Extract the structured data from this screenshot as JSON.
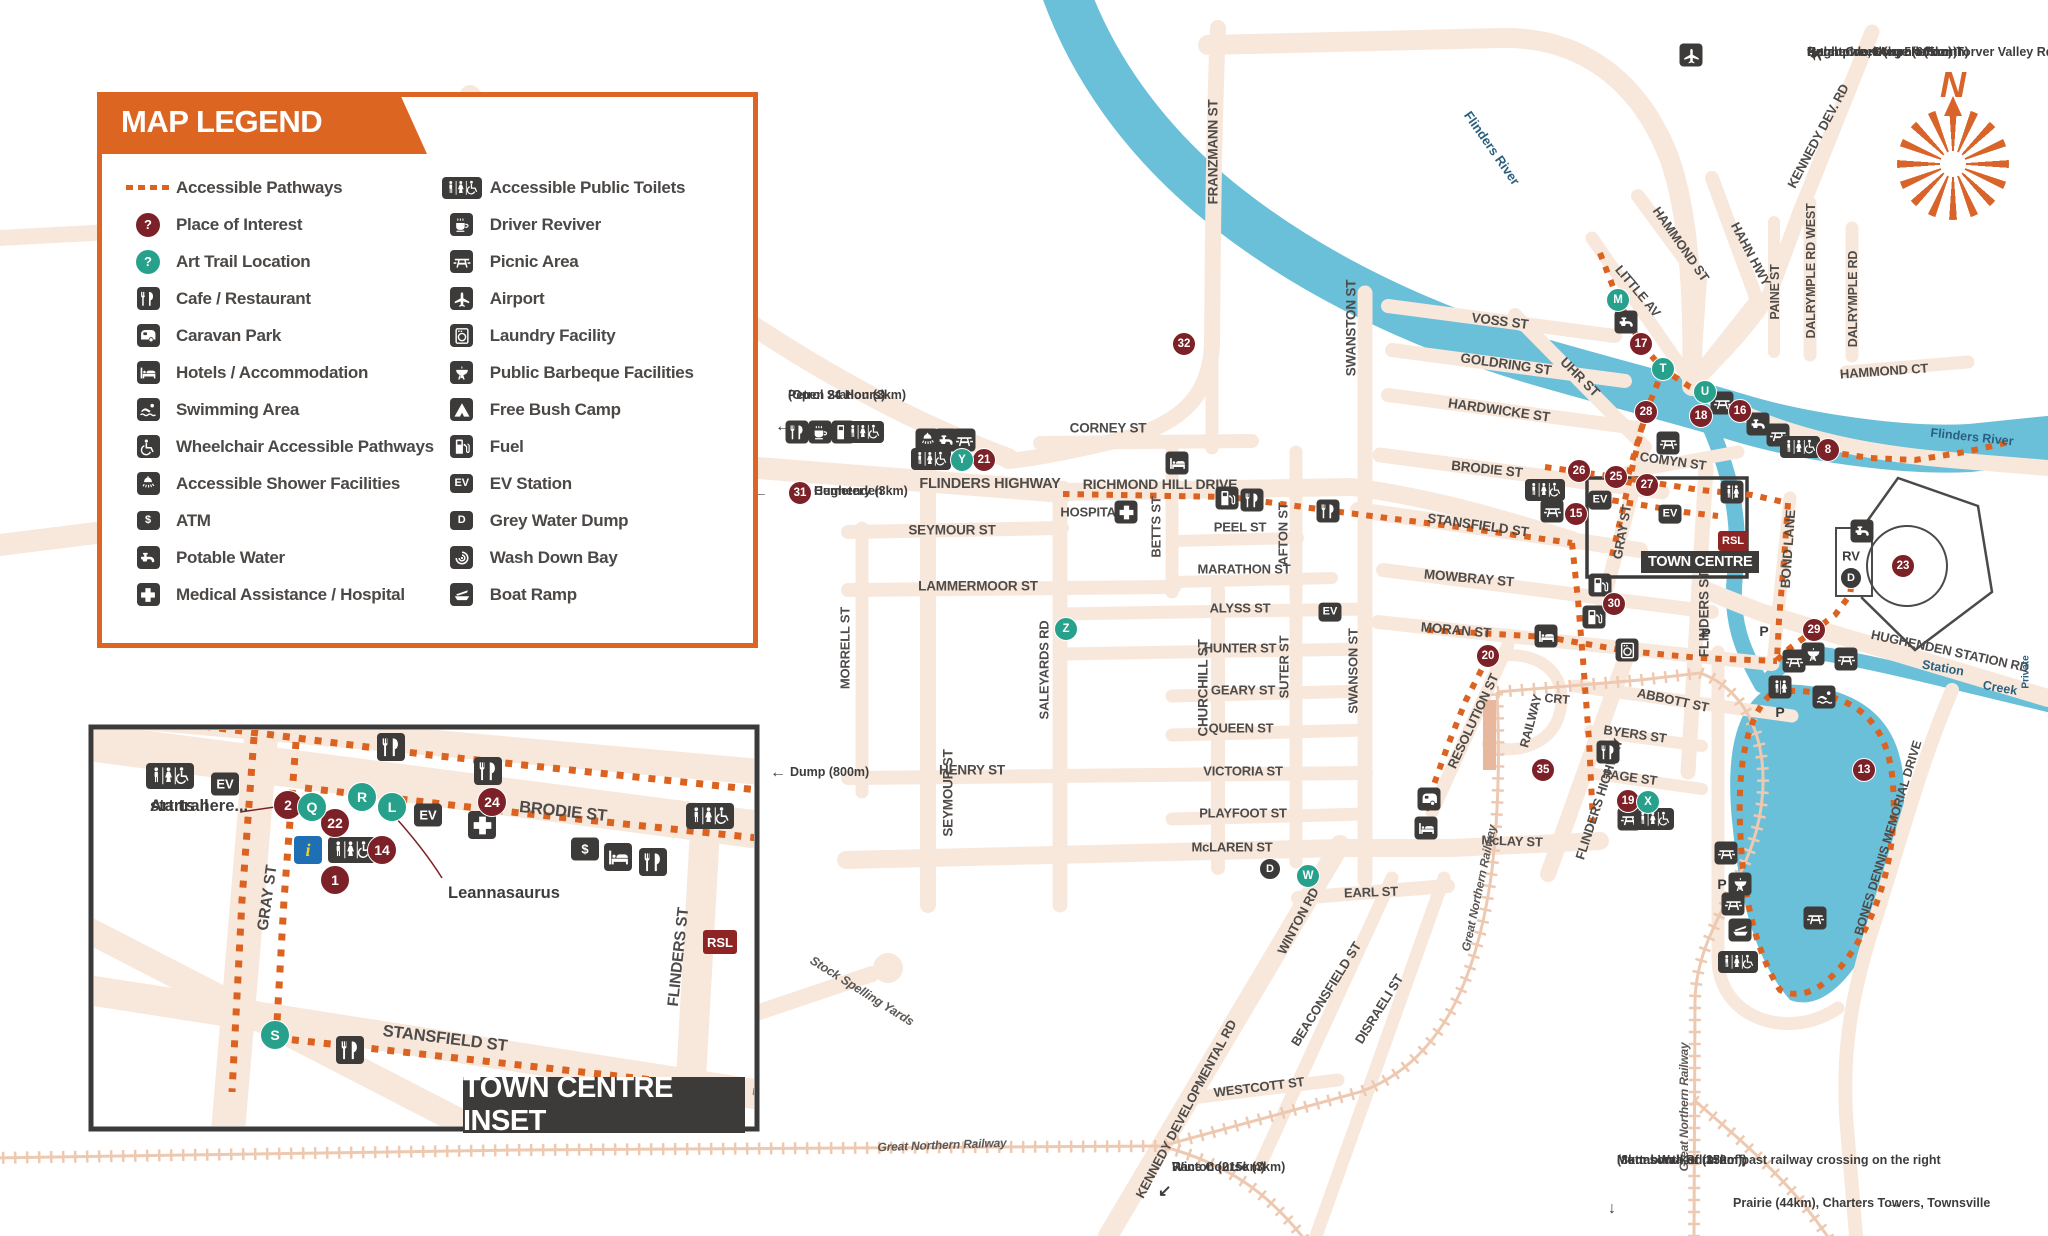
{
  "colors": {
    "road": "#f8e8dc",
    "river": "#6abfd9",
    "orange": "#dc6220",
    "dark": "#3d3b3a",
    "maroon": "#7c2127",
    "teal": "#27a18c",
    "street_text": "#4e4b49",
    "water_text": "#29607f",
    "railway": "#eec9b1"
  },
  "legend": {
    "title": "MAP LEGEND",
    "left": [
      {
        "icon": "dotted",
        "label": "Accessible Pathways"
      },
      {
        "icon": "poi",
        "label": "Place of Interest"
      },
      {
        "icon": "art",
        "label": "Art Trail Location"
      },
      {
        "icon": "cafe",
        "label": "Cafe / Restaurant"
      },
      {
        "icon": "caravan",
        "label": "Caravan Park"
      },
      {
        "icon": "hotel",
        "label": "Hotels / Accommodation"
      },
      {
        "icon": "swim",
        "label": "Swimming Area"
      },
      {
        "icon": "wheelchair",
        "label": "Wheelchair Accessible Pathways"
      },
      {
        "icon": "shower",
        "label": "Accessible Shower Facilities"
      },
      {
        "icon": "atm",
        "label": "ATM"
      },
      {
        "icon": "tap",
        "label": "Potable Water"
      },
      {
        "icon": "cross",
        "label": "Medical Assistance / Hospital"
      }
    ],
    "right": [
      {
        "icon": "wc",
        "label": "Accessible Public Toilets"
      },
      {
        "icon": "coffee",
        "label": "Driver Reviver"
      },
      {
        "icon": "picnic",
        "label": "Picnic Area"
      },
      {
        "icon": "plane",
        "label": "Airport"
      },
      {
        "icon": "laundry",
        "label": "Laundry Facility"
      },
      {
        "icon": "bbq",
        "label": "Public Barbeque Facilities"
      },
      {
        "icon": "tent",
        "label": "Free Bush Camp"
      },
      {
        "icon": "fuel",
        "label": "Fuel"
      },
      {
        "icon": "ev",
        "label": "EV Station"
      },
      {
        "icon": "dumpD",
        "label": "Grey Water Dump"
      },
      {
        "icon": "wash",
        "label": "Wash Down Bay"
      },
      {
        "icon": "boat",
        "label": "Boat Ramp"
      }
    ]
  },
  "inset": {
    "title": "TOWN CENTRE INSET"
  },
  "town_centre_label": "TOWN CENTRE",
  "compass_n": "N",
  "streets": [
    [
      "FRANZMANN ST",
      1213,
      152,
      -90,
      13.5
    ],
    [
      "FLINDERS HIGHWAY",
      990,
      484,
      0,
      14.5
    ],
    [
      "RICHMOND HILL DRIVE",
      1160,
      484,
      0,
      14
    ],
    [
      "CORNEY ST",
      1108,
      428,
      0,
      13.5
    ],
    [
      "SEYMOUR ST",
      952,
      530,
      0,
      13.5
    ],
    [
      "LAMMERMOOR ST",
      978,
      586,
      0,
      13.5
    ],
    [
      "HENRY ST",
      972,
      770,
      0,
      13.5
    ],
    [
      "SEYMOUR ST",
      948,
      793,
      -90,
      13.5
    ],
    [
      "MORRELL ST",
      845,
      648,
      -90,
      13
    ],
    [
      "SALEYARDS RD",
      1044,
      670,
      -90,
      13
    ],
    [
      "CHURCHILL ST",
      1203,
      688,
      -90,
      13.5
    ],
    [
      "BETTS ST",
      1156,
      527,
      -90,
      13
    ],
    [
      "PEEL ST",
      1240,
      527,
      0,
      13
    ],
    [
      "MARATHON ST",
      1244,
      569,
      0,
      13
    ],
    [
      "ALYSS ST",
      1240,
      608,
      0,
      13
    ],
    [
      "HUNTER ST",
      1240,
      648,
      0,
      13
    ],
    [
      "GEARY ST",
      1243,
      690,
      0,
      13
    ],
    [
      "QUEEN ST",
      1241,
      728,
      0,
      13
    ],
    [
      "VICTORIA ST",
      1243,
      771,
      0,
      13
    ],
    [
      "PLAYFOOT ST",
      1243,
      813,
      0,
      13
    ],
    [
      "McLAREN ST",
      1232,
      847,
      0,
      13
    ],
    [
      "AFTON ST",
      1283,
      534,
      -90,
      13
    ],
    [
      "SUTER ST",
      1284,
      667,
      -90,
      13
    ],
    [
      "SWANSTON ST",
      1351,
      328,
      -90,
      13.5
    ],
    [
      "SWANSON ST",
      1353,
      671,
      -90,
      13
    ],
    [
      "VOSS ST",
      1500,
      321,
      7,
      13.5
    ],
    [
      "GOLDRING ST",
      1506,
      364,
      8,
      13.5
    ],
    [
      "HARDWICKE ST",
      1499,
      410,
      8,
      13.5
    ],
    [
      "BRODIE ST",
      1487,
      469,
      6,
      13.5
    ],
    [
      "STANSFIELD ST",
      1478,
      525,
      8,
      13.5
    ],
    [
      "MOWBRAY ST",
      1469,
      578,
      5,
      13.5
    ],
    [
      "MORAN ST",
      1456,
      630,
      5,
      13.5
    ],
    [
      "UHR ST",
      1580,
      377,
      45,
      13.5
    ],
    [
      "LITTLE AV",
      1638,
      291,
      50,
      13
    ],
    [
      "HAMMOND ST",
      1681,
      244,
      55,
      13
    ],
    [
      "HAHN HWY",
      1751,
      254,
      62,
      13
    ],
    [
      "PAINE ST",
      1775,
      292,
      -90,
      12.5
    ],
    [
      "DALRYMPLE RD WEST",
      1811,
      271,
      -90,
      12.5
    ],
    [
      "DALRYMPLE RD",
      1853,
      299,
      -90,
      12.5
    ],
    [
      "KENNEDY DEV. RD",
      1818,
      136,
      -62,
      13
    ],
    [
      "HAMMOND CT",
      1884,
      371,
      -4,
      13
    ],
    [
      "COMYN ST",
      1673,
      461,
      8,
      13
    ],
    [
      "GRAY ST",
      1622,
      532,
      -80,
      13
    ],
    [
      "FLINDERS ST",
      1704,
      614,
      -90,
      13.5
    ],
    [
      "BOND LANE",
      1788,
      549,
      -86,
      13.5
    ],
    [
      "ABBOTT ST",
      1673,
      700,
      12,
      13
    ],
    [
      "BYERS ST",
      1635,
      734,
      8,
      13
    ],
    [
      "PAGE ST",
      1630,
      777,
      8,
      13
    ],
    [
      "RAILWAY",
      1531,
      721,
      -75,
      12.5
    ],
    [
      "CRT",
      1557,
      699,
      5,
      12.5
    ],
    [
      "RESOLUTION ST",
      1473,
      721,
      -65,
      13
    ],
    [
      "FLINDERS HIGHWAY",
      1599,
      799,
      -72,
      13
    ],
    [
      "McLAY ST",
      1512,
      841,
      2,
      13
    ],
    [
      "EARL ST",
      1371,
      892,
      -2,
      13
    ],
    [
      "WESTCOTT ST",
      1259,
      1087,
      -7,
      13
    ],
    [
      "WINTON RD",
      1298,
      921,
      -62,
      13
    ],
    [
      "BEACONSFIELD ST",
      1326,
      994,
      -58,
      13
    ],
    [
      "DISRAELI ST",
      1379,
      1009,
      -58,
      13
    ],
    [
      "KENNEDY DEVELOPMENTAL RD",
      1186,
      1109,
      -62,
      13
    ],
    [
      "HUGHENDEN STATION RD",
      1950,
      651,
      12,
      13
    ],
    [
      "BONES DENNIS MEMORIAL DRIVE",
      1888,
      838,
      -73,
      12.5
    ],
    [
      "HOSPITAL",
      1092,
      512,
      0,
      13
    ],
    [
      "Stock Spelling Yards",
      862,
      991,
      32,
      12.5,
      "it"
    ],
    [
      "Great Northern Railway",
      942,
      1145,
      -2,
      12,
      "it"
    ],
    [
      "Great Northern Railway",
      1479,
      888,
      -78,
      12,
      "it"
    ],
    [
      "Great Northern Railway",
      1684,
      1107,
      -90,
      12,
      "it"
    ],
    [
      "BRODIE ST",
      563,
      812,
      6,
      16.5
    ],
    [
      "GRAY ST",
      268,
      898,
      -82,
      15.5
    ],
    [
      "STANSFIELD ST",
      445,
      1039,
      7,
      16.5
    ],
    [
      "FLINDERS ST",
      679,
      957,
      -84,
      15.5
    ]
  ],
  "water_labels": [
    [
      "Flinders River",
      1492,
      148,
      55,
      13
    ],
    [
      "Flinders River",
      1972,
      437,
      6,
      12.5
    ],
    [
      "Station",
      1943,
      668,
      10,
      12.5
    ],
    [
      "Creek",
      2000,
      688,
      10,
      12.5
    ],
    [
      "Private",
      2026,
      672,
      -90,
      10
    ]
  ],
  "notes": [
    {
      "lines": [
        "Hughenden Airport (5km)",
        "Porcupine Gorge (60km)",
        "Galah Creek (turn left on Torver Valley Rd, 2.4km",
        "from town, then 5km north)"
      ],
      "x": 1807,
      "y": 45,
      "align": "right"
    },
    {
      "lines": [
        "Petrol Station (3km)",
        "(Open 24 Hours)"
      ],
      "x": 788,
      "y": 388,
      "align": "left"
    },
    {
      "lines": [
        "Hughenden",
        "Cemetery (3km)"
      ],
      "x": 814,
      "y": 484,
      "align": "left"
    },
    {
      "lines": [
        "Dump (800m)"
      ],
      "x": 790,
      "y": 765,
      "align": "left"
    },
    {
      "lines": [
        "Race Course (3km)",
        "Winton (215km)"
      ],
      "x": 1172,
      "y": 1160,
      "align": "left"
    },
    {
      "lines": [
        "Muttaburra Rd 350m past railway crossing on the right",
        "Mount Walker (13km)",
        "(8km south of turnoff)"
      ],
      "x": 1617,
      "y": 1153,
      "align": "right"
    },
    {
      "lines": [
        "Prairie (44km), Charters Towers, Townsville"
      ],
      "x": 1733,
      "y": 1196,
      "align": "left"
    },
    {
      "lines": [
        "Art trail",
        "starts here..."
      ],
      "x": 150,
      "y": 797,
      "align": "left",
      "cls": "big"
    },
    {
      "lines": [
        "Leannasaurus"
      ],
      "x": 448,
      "y": 884,
      "align": "left",
      "cls": "big"
    }
  ],
  "arrows": [
    [
      "←",
      775,
      418
    ],
    [
      "←",
      752,
      484
    ],
    [
      "←",
      770,
      764
    ],
    [
      "↙",
      1158,
      1181
    ],
    [
      "↓",
      1608,
      1200
    ],
    [
      "→",
      1886,
      1195
    ]
  ],
  "poi": [
    [
      "32",
      1184,
      344,
      0
    ],
    [
      "21",
      984,
      460,
      0
    ],
    [
      "31",
      800,
      493,
      0
    ],
    [
      "17",
      1641,
      344,
      0
    ],
    [
      "28",
      1646,
      412,
      0
    ],
    [
      "18",
      1701,
      416,
      0
    ],
    [
      "16",
      1740,
      411,
      0
    ],
    [
      "8",
      1828,
      450,
      0
    ],
    [
      "26",
      1579,
      471,
      0
    ],
    [
      "25",
      1616,
      477,
      0
    ],
    [
      "27",
      1647,
      485,
      0
    ],
    [
      "15",
      1576,
      514,
      0
    ],
    [
      "30",
      1614,
      604,
      0
    ],
    [
      "20",
      1488,
      656,
      0
    ],
    [
      "35",
      1543,
      770,
      0
    ],
    [
      "19",
      1628,
      801,
      0
    ],
    [
      "29",
      1814,
      630,
      0
    ],
    [
      "23",
      1903,
      566,
      0
    ],
    [
      "13",
      1864,
      770,
      0
    ],
    [
      "2",
      288,
      805,
      1
    ],
    [
      "22",
      335,
      823,
      1
    ],
    [
      "24",
      492,
      802,
      1
    ],
    [
      "14",
      382,
      850,
      1
    ],
    [
      "1",
      335,
      880,
      1
    ]
  ],
  "art": [
    [
      "M",
      1618,
      300,
      0
    ],
    [
      "T",
      1663,
      369,
      0
    ],
    [
      "U",
      1705,
      392,
      0
    ],
    [
      "Y",
      962,
      460,
      0
    ],
    [
      "Z",
      1066,
      629,
      0
    ],
    [
      "X",
      1648,
      802,
      0
    ],
    [
      "W",
      1308,
      876,
      0
    ],
    [
      "Q",
      312,
      807,
      1
    ],
    [
      "R",
      362,
      797,
      1
    ],
    [
      "L",
      392,
      807,
      1
    ],
    [
      "S",
      275,
      1035,
      1
    ]
  ],
  "dark_circles": [
    [
      "D",
      1851,
      578
    ],
    [
      "D",
      1270,
      869
    ]
  ],
  "icons": [
    [
      "cafe",
      797,
      432,
      0
    ],
    [
      "coffee",
      820,
      432,
      0
    ],
    [
      "fuel",
      843,
      432,
      0
    ],
    [
      "wc",
      864,
      432,
      0
    ],
    [
      "shower",
      927,
      440,
      0
    ],
    [
      "tap",
      946,
      440,
      0
    ],
    [
      "picnic",
      964,
      440,
      0
    ],
    [
      "wc",
      931,
      459,
      0
    ],
    [
      "hotel",
      1177,
      463,
      0
    ],
    [
      "cross",
      1126,
      512,
      0
    ],
    [
      "fuel",
      1227,
      498,
      0
    ],
    [
      "cafe",
      1252,
      500,
      0
    ],
    [
      "cafe",
      1328,
      511,
      0
    ],
    [
      "ev",
      1330,
      612,
      0
    ],
    [
      "hotel",
      1546,
      636,
      0
    ],
    [
      "laundry",
      1627,
      650,
      0
    ],
    [
      "fuel",
      1600,
      585,
      0
    ],
    [
      "fuel",
      1594,
      617,
      0
    ],
    [
      "caravan",
      1429,
      799,
      0
    ],
    [
      "hotel",
      1426,
      828,
      0
    ],
    [
      "cafe",
      1608,
      752,
      0
    ],
    [
      "picnic",
      1629,
      819,
      0
    ],
    [
      "wc",
      1654,
      819,
      0
    ],
    [
      "wc",
      1545,
      490,
      0
    ],
    [
      "picnic",
      1552,
      511,
      0
    ],
    [
      "picnic",
      1668,
      443,
      0
    ],
    [
      "wc2",
      1732,
      492,
      0
    ],
    [
      "ev",
      1600,
      500,
      0
    ],
    [
      "ev",
      1670,
      514,
      0
    ],
    [
      "tap",
      1626,
      322,
      0
    ],
    [
      "picnic",
      1722,
      403,
      0
    ],
    [
      "tap",
      1758,
      424,
      0
    ],
    [
      "picnic",
      1778,
      435,
      0
    ],
    [
      "wc",
      1800,
      447,
      0
    ],
    [
      "tap",
      1862,
      531,
      0
    ],
    [
      "bbq",
      1813,
      654,
      0
    ],
    [
      "picnic",
      1794,
      661,
      0
    ],
    [
      "picnic",
      1846,
      659,
      0
    ],
    [
      "wc2",
      1780,
      687,
      0
    ],
    [
      "swim",
      1824,
      697,
      0
    ],
    [
      "picnic",
      1726,
      853,
      0
    ],
    [
      "bbq",
      1740,
      884,
      0
    ],
    [
      "picnic",
      1733,
      904,
      0
    ],
    [
      "boat",
      1740,
      930,
      0
    ],
    [
      "wc",
      1738,
      962,
      0
    ],
    [
      "picnic",
      1815,
      918,
      0
    ],
    [
      "plane",
      1691,
      55,
      0
    ],
    [
      "plane_free",
      1818,
      53,
      0
    ],
    [
      "wc",
      170,
      776,
      1
    ],
    [
      "ev",
      225,
      784,
      1
    ],
    [
      "cafe",
      391,
      747,
      1
    ],
    [
      "cafe",
      488,
      771,
      1
    ],
    [
      "wc",
      710,
      816,
      1
    ],
    [
      "ev",
      428,
      815,
      1
    ],
    [
      "cross",
      482,
      825,
      1
    ],
    [
      "info",
      308,
      850,
      1
    ],
    [
      "wc",
      352,
      850,
      1
    ],
    [
      "atm",
      585,
      849,
      1
    ],
    [
      "hotel",
      618,
      857,
      1
    ],
    [
      "cafe",
      653,
      862,
      1
    ],
    [
      "cafe",
      350,
      1050,
      1
    ]
  ],
  "texticons": [
    [
      "RSL",
      1733,
      541,
      0
    ],
    [
      "RSL",
      720,
      942,
      1
    ],
    [
      "RV",
      1851,
      556,
      0
    ]
  ],
  "plabels": [
    [
      1706,
      633
    ],
    [
      1764,
      631
    ],
    [
      1780,
      712
    ],
    [
      1722,
      884
    ]
  ]
}
